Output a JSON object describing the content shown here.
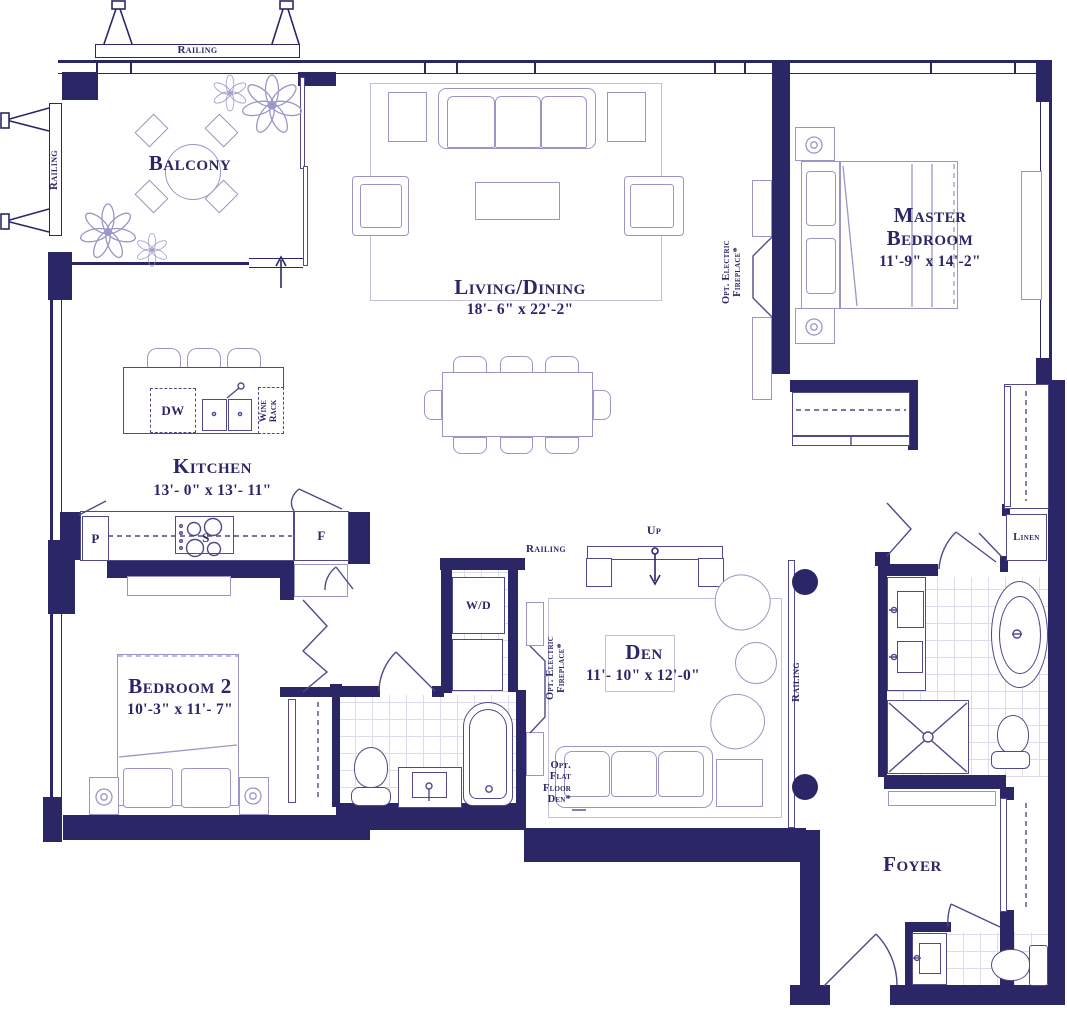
{
  "title": "Condominium unit floor plan",
  "colors": {
    "wall": "#2b2766",
    "furniture_line": "#9a97c8",
    "fixture_line": "#4e4a8c",
    "tile_line": "#dddcec"
  },
  "rooms": {
    "balcony": {
      "name": "Balcony"
    },
    "living_dining": {
      "name": "Living/Dining",
      "dims": "18'- 6\" x 22'-2\""
    },
    "master_bedroom": {
      "line1": "Master",
      "line2": "Bedroom",
      "dims": "11'-9\" x 14'-2\""
    },
    "kitchen": {
      "name": "Kitchen",
      "dims": "13'- 0\" x 13'- 11\""
    },
    "bedroom2": {
      "name": "Bedroom 2",
      "dims": "10'-3\" x 11'- 7\""
    },
    "den": {
      "name": "Den",
      "dims": "11'- 10\" x 12'-0\""
    },
    "foyer": {
      "name": "Foyer"
    },
    "linen": {
      "name": "Linen"
    }
  },
  "labels": {
    "railing": "Railing",
    "up": "Up",
    "washer_dryer": "W/D",
    "dishwasher": "DW",
    "wine_rack_line1": "Wine",
    "wine_rack_line2": "Rack",
    "pantry": "P",
    "fridge": "F",
    "stove": "S",
    "opt_fireplace_line1": "Opt. Electric",
    "opt_fireplace_line2": "Fireplace*",
    "opt_flat_line1": "Opt.",
    "opt_flat_line2": "Flat",
    "opt_flat_line3": "Floor",
    "opt_flat_line4": "Den*"
  }
}
